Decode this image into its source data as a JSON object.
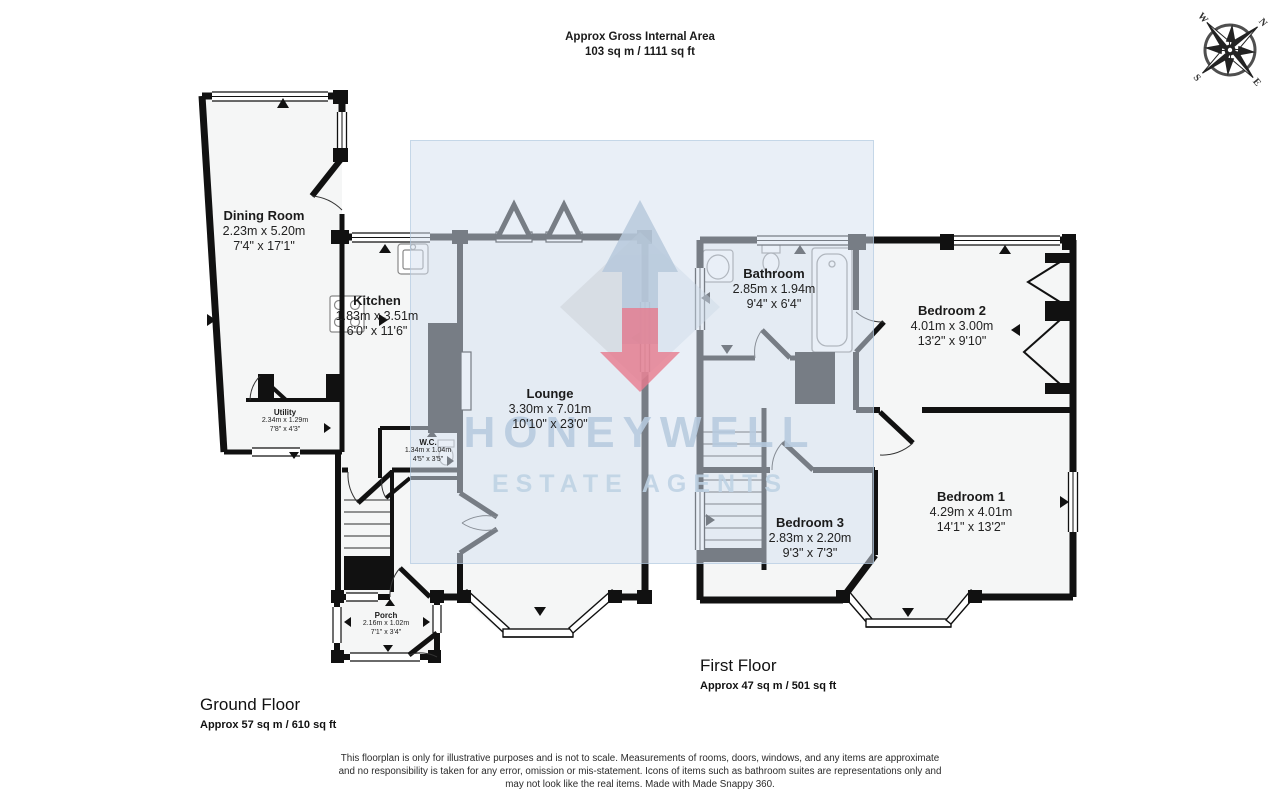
{
  "header": {
    "line1": "Approx Gross Internal Area",
    "line2": "103 sq m / 1111 sq ft"
  },
  "compass": {
    "n": "N",
    "e": "E",
    "s": "S",
    "w": "W"
  },
  "watermark": {
    "line1": "HONEYWELL",
    "line2": "ESTATE AGENTS",
    "accent_blue": "#b7cbdf",
    "accent_red": "#e87b8e"
  },
  "floors": {
    "ground": {
      "title": "Ground Floor",
      "area": "Approx 57 sq m / 610 sq ft",
      "rooms": [
        {
          "name": "Dining Room",
          "metric": "2.23m x 5.20m",
          "imperial": "7'4\" x 17'1\""
        },
        {
          "name": "Kitchen",
          "metric": "1.83m x 3.51m",
          "imperial": "6'0\" x 11'6\""
        },
        {
          "name": "Lounge",
          "metric": "3.30m x 7.01m",
          "imperial": "10'10\" x 23'0\""
        },
        {
          "name": "Utility",
          "metric": "2.34m x 1.29m",
          "imperial": "7'8\" x 4'3\""
        },
        {
          "name": "W.C.",
          "metric": "1.34m x 1.04m",
          "imperial": "4'5\" x 3'5\""
        },
        {
          "name": "Porch",
          "metric": "2.16m x 1.02m",
          "imperial": "7'1\" x 3'4\""
        }
      ]
    },
    "first": {
      "title": "First Floor",
      "area": "Approx 47 sq m / 501 sq ft",
      "rooms": [
        {
          "name": "Bathroom",
          "metric": "2.85m x 1.94m",
          "imperial": "9'4\" x 6'4\""
        },
        {
          "name": "Bedroom 2",
          "metric": "4.01m x 3.00m",
          "imperial": "13'2\" x 9'10\""
        },
        {
          "name": "Bedroom 3",
          "metric": "2.83m x 2.20m",
          "imperial": "9'3\" x 7'3\""
        },
        {
          "name": "Bedroom 1",
          "metric": "4.29m x 4.01m",
          "imperial": "14'1\" x 13'2\""
        }
      ]
    }
  },
  "disclaimer": {
    "lines": [
      "This floorplan is only for illustrative purposes and is not to scale. Measurements of rooms, doors, windows, and any items are approximate",
      "and no responsibility is taken for any error, omission or mis-statement. Icons of items such as bathroom suites are representations only and",
      "may not look like the real items. Made with Made Snappy 360."
    ]
  }
}
